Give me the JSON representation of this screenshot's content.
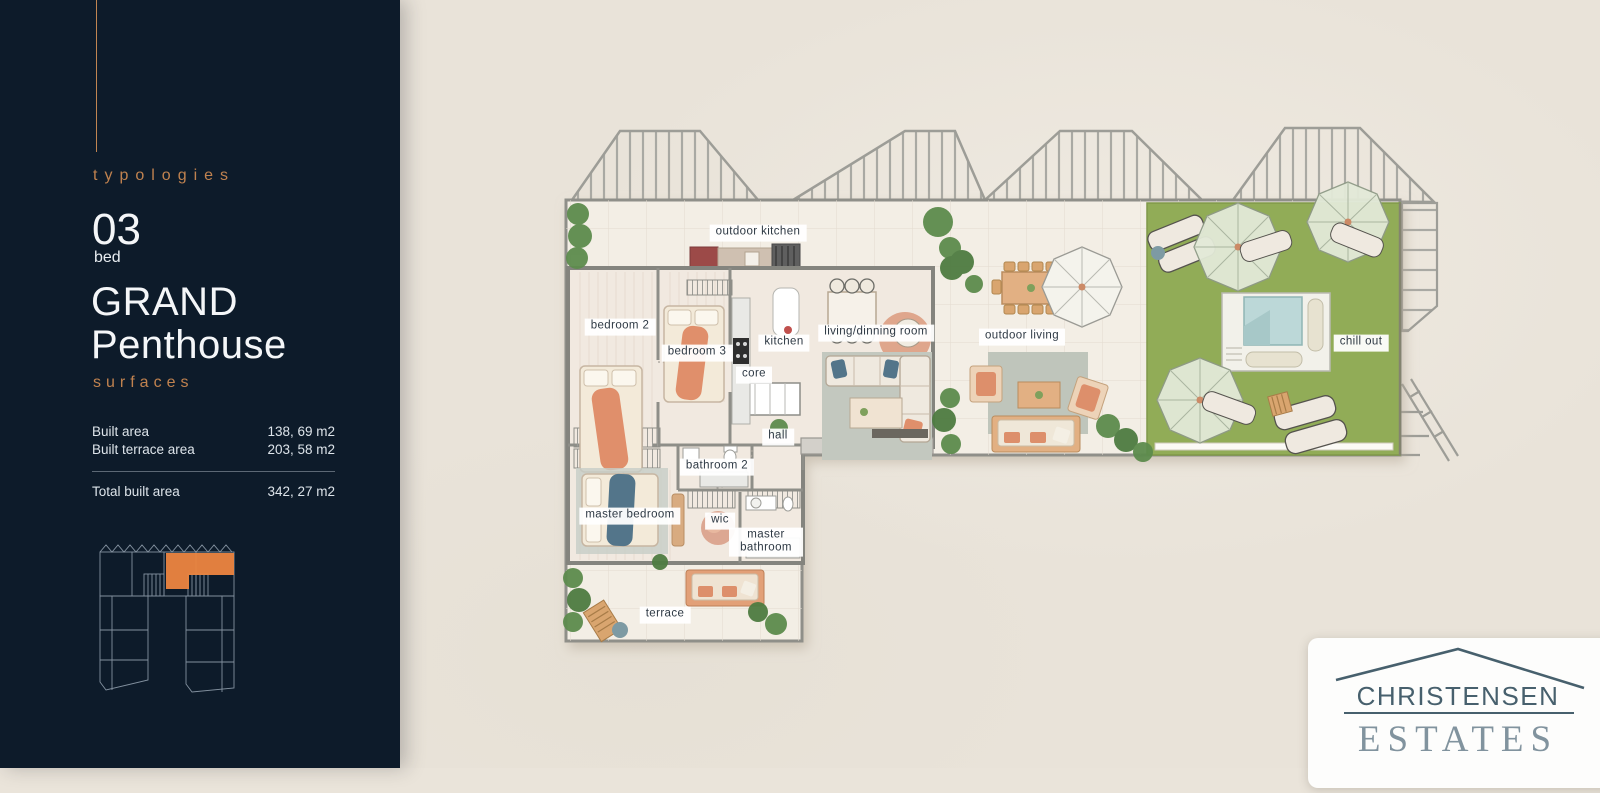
{
  "sidebar": {
    "eyebrow": "typologies",
    "unit_number": "03",
    "unit_label": "bed",
    "title_line1": "GRAND",
    "title_line2": "Penthouse",
    "section_label": "surfaces",
    "surfaces": {
      "rows": [
        {
          "label": "Built area",
          "value": "138, 69 m2"
        },
        {
          "label": "Built terrace area",
          "value": "203, 58 m2"
        }
      ],
      "total": {
        "label": "Total built area",
        "value": "342, 27 m2"
      }
    }
  },
  "plan": {
    "labels": [
      {
        "id": "outdoor-kitchen",
        "text": "outdoor kitchen"
      },
      {
        "id": "bedroom-2",
        "text": "bedroom 2"
      },
      {
        "id": "bedroom-3",
        "text": "bedroom 3"
      },
      {
        "id": "kitchen",
        "text": "kitchen"
      },
      {
        "id": "core",
        "text": "core"
      },
      {
        "id": "living-dinning-room",
        "text": "living/dinning room"
      },
      {
        "id": "outdoor-living",
        "text": "outdoor living"
      },
      {
        "id": "chill-out",
        "text": "chill out"
      },
      {
        "id": "hall",
        "text": "hall"
      },
      {
        "id": "bathroom-2",
        "text": "bathroom 2"
      },
      {
        "id": "master-bedroom",
        "text": "master bedroom"
      },
      {
        "id": "wic",
        "text": "wic"
      },
      {
        "id": "master-bathroom",
        "text": "master bathroom"
      },
      {
        "id": "terrace",
        "text": "terrace"
      }
    ],
    "colors": {
      "sidebar_navy": "#0d1b2a",
      "accent_orange": "#c0824f",
      "keyplan_highlight": "#ea8440",
      "lawn_green": "#94af59",
      "floor_cream": "#f2ede4",
      "furniture_salmon": "#e08f6b",
      "logo_slate": "#47606d"
    }
  },
  "logo": {
    "line1": "CHRISTENSEN",
    "line2": "ESTATES"
  }
}
